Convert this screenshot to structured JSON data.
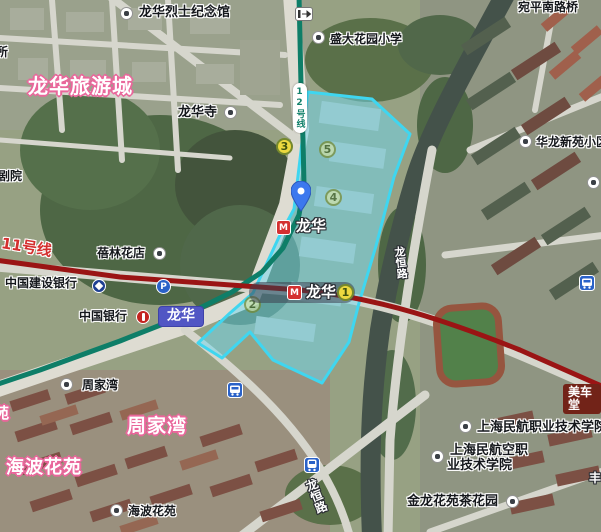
{
  "colors": {
    "selection_fill": "#6ed8f0",
    "selection_border": "#3fd6f0",
    "line11_color": "#9a1414",
    "line12_color": "#0e7e68",
    "district_label_outline": "#e9679b",
    "railway_badge": "#5156c4",
    "marker_fill": "#ecd93f",
    "marker_border": "#75882d",
    "transit_icon_blue": "#2a62c8",
    "metro_logo_red": "#d43030"
  },
  "lines": {
    "line11_label": "11号线",
    "line12_label": "12号线"
  },
  "stations": {
    "longhua_metro_upper": "龙华",
    "longhua_metro_lower": "龙华",
    "longhua_railway_badge": "龙华"
  },
  "markers": {
    "m1": "1",
    "m2": "2",
    "m3": "3",
    "m4": "4",
    "m5": "5"
  },
  "icons": {
    "parking_glyph": "P",
    "metro_logo_glyph": "M"
  },
  "labels": {
    "martyrs_memorial": "龙华烈士纪念馆",
    "partial_suo": "所",
    "partial_theater": "剧院",
    "tourist_city": "龙华旅游城",
    "longhua_temple": "龙华寺",
    "shengda_primary_school": "盛大花园小学",
    "wanping_south_road_bridge": "宛平南路桥",
    "hualong_new_estate": "华龙新苑小区",
    "beilin_flower_shop": "蓓林花店",
    "ccb": "中国建设银行",
    "boc": "中国银行",
    "zhoujiawan_stop": "周家湾",
    "zhoujiawan_area": "周家湾",
    "partial_yuan": "苑",
    "haibo_garden_area": "海波花苑",
    "haibo_garden_stop": "海波花苑",
    "meichetang": "美车堂",
    "aviation_college": "上海民航职业技术学院",
    "aviation_college_alt_line1": "上海民航空职",
    "aviation_college_alt_line2": "业技术学院",
    "jinlong_tea_garden": "金龙花苑茶花园",
    "longheng_road_upper": "龙恒路",
    "longheng_road_lower": "龙恒路",
    "partial_feng": "丰"
  }
}
